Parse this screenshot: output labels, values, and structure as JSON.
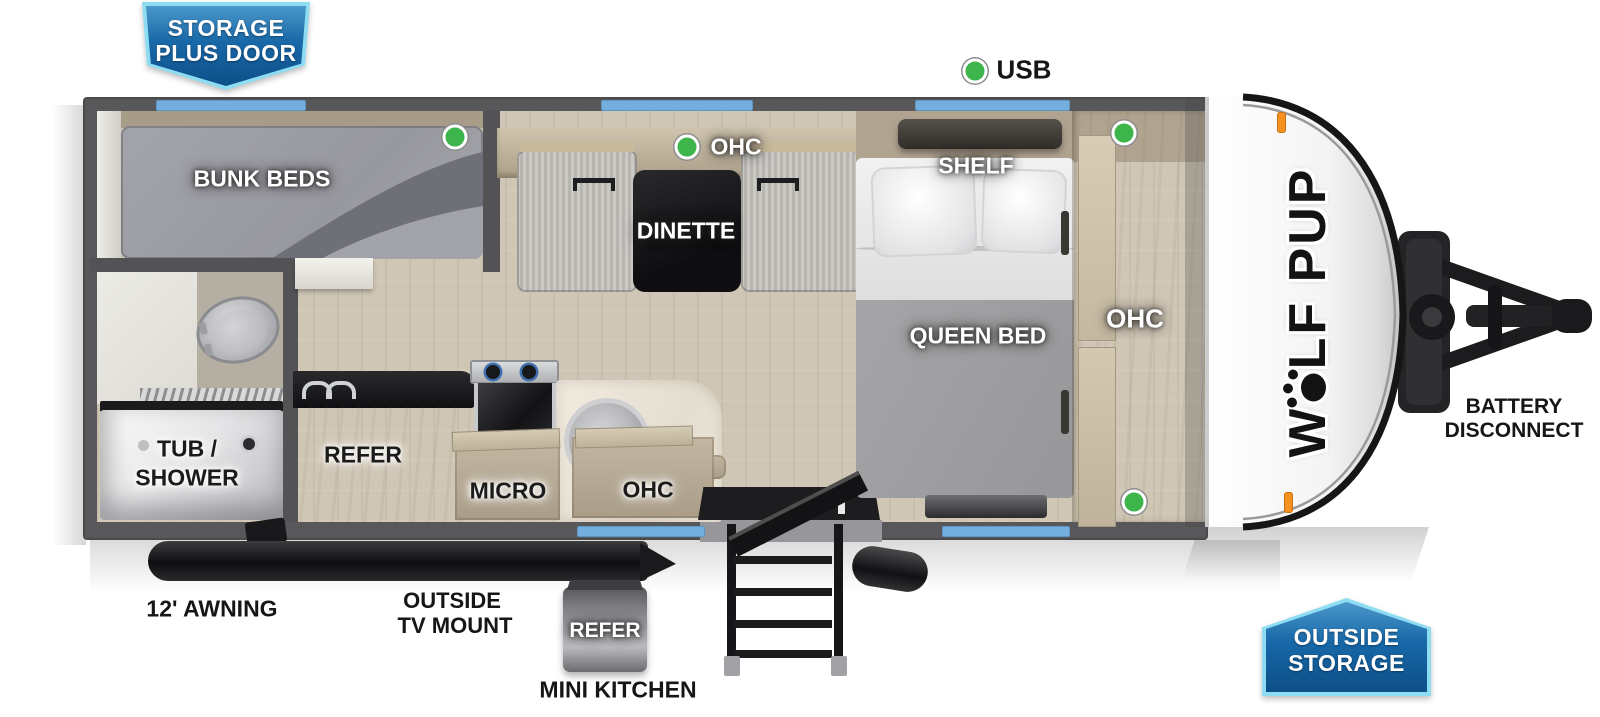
{
  "badges": {
    "storage_plus_door": {
      "line1": "STORAGE",
      "line2": "PLUS DOOR"
    },
    "outside_storage": {
      "line1": "OUTSIDE",
      "line2": "STORAGE"
    }
  },
  "callouts": {
    "usb": "USB",
    "battery_disconnect": {
      "line1": "BATTERY",
      "line2": "DISCONNECT"
    },
    "awning": "12' AWNING",
    "outside_tv_mount": {
      "line1": "OUTSIDE",
      "line2": "TV MOUNT"
    },
    "mini_kitchen": "MINI KITCHEN",
    "mini_kitchen_refer": "REFER"
  },
  "rooms": {
    "bunk_beds": "BUNK BEDS",
    "dinette": "DINETTE",
    "dinette_ohc": "OHC",
    "shelf": "SHELF",
    "queen_bed": "QUEEN BED",
    "bedroom_ohc": "OHC",
    "tub_shower": {
      "line1": "TUB /",
      "line2": "SHOWER"
    },
    "refer": "REFER",
    "micro": "MICRO",
    "kitchen_ohc": "OHC"
  },
  "brand": {
    "logo_first_letter": "W",
    "logo_rest": "LF PUP"
  },
  "colors": {
    "wall_gray": "#58585a",
    "window_blue": "#74aede",
    "indicator_green": "#3db54b",
    "marker_orange": "#f5921f",
    "badge_blue": "#0d4f88",
    "badge_border": "#8edcf2"
  }
}
